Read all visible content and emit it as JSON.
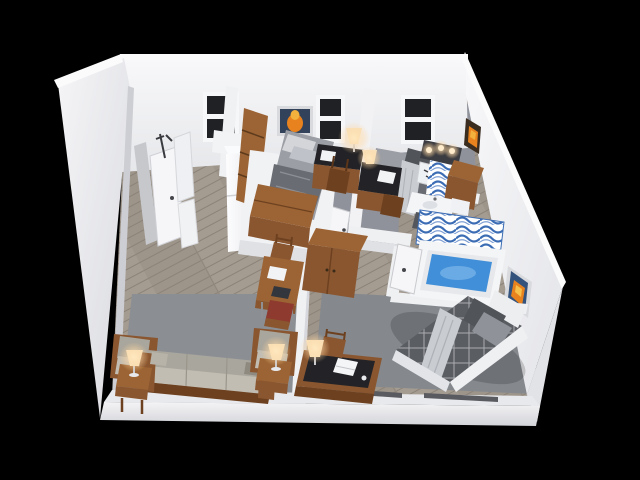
{
  "scene": {
    "description": "3D isometric cutaway floor plan render of a furnished two-bedroom apartment, viewed from above on a black background",
    "background": "#000000"
  },
  "colors": {
    "wall_bright": "#f4f4f6",
    "wall_mid": "#e7e8eb",
    "wall_shadow": "#cfd1d6",
    "wall_top": "#fbfbfc",
    "floor_wood": "#a49b91",
    "carpet_bedroom": "#8f929a",
    "rug_living": "#8b8f94",
    "rug_bedroom3": "#85898e",
    "wood_mid": "#8a5630",
    "wood_dark": "#6d4120",
    "wood_top": "#9c6434",
    "desk_top_black": "#232327",
    "bedding_gray": "#9b9ea4",
    "blanket_dark": "#696c72",
    "comforter_dark": "#5a5d62",
    "pillow_light": "#d3d5d9",
    "pillow_dark": "#515459",
    "drape_light": "#c9ccd1",
    "sofa_back": "#a9a69d",
    "sofa_seat": "#c2bdb2",
    "lamp_shade": "#f7e4c2",
    "water_blue": "#418fd9",
    "curtain_blue": "#3c6db4",
    "window_pane": "#202125",
    "art_orange": "#e8821e",
    "fixture_white": "#f4f5f7",
    "chair_red_seat": "#8e3a2e"
  },
  "rooms": [
    {
      "id": "entry",
      "label": "entry hall",
      "furniture": [
        "entry-door",
        "coat-rack",
        "wall-mirror",
        "shoe-cabinet"
      ]
    },
    {
      "id": "kitchen",
      "label": "kitchenette",
      "furniture": [
        "refrigerator",
        "upper-cabinet"
      ]
    },
    {
      "id": "bedroom-1",
      "label": "bedroom 1",
      "furniture": [
        "twin-bed",
        "storage-chest",
        "tall-bookcase",
        "desk",
        "desk-chair",
        "desk-lamp",
        "wall-art",
        "window"
      ]
    },
    {
      "id": "bedroom-2",
      "label": "bedroom 2",
      "furniture": [
        "twin-bed",
        "desk",
        "desk-chair",
        "desk-lamp",
        "vanity-sink",
        "vanity-lights",
        "striped-towels",
        "window"
      ]
    },
    {
      "id": "bathroom",
      "label": "bathroom",
      "furniture": [
        "bathtub",
        "shower-curtain",
        "toilet",
        "sink-counter",
        "wood-cabinet",
        "bathroom-door",
        "floor-mat"
      ]
    },
    {
      "id": "bedroom-3",
      "label": "bedroom 3",
      "furniture": [
        "double-bed",
        "pillows",
        "throw-blanket",
        "desk",
        "desk-chair",
        "desk-lamp",
        "area-rug",
        "wall-art"
      ]
    },
    {
      "id": "living-room",
      "label": "living room",
      "furniture": [
        "sofa",
        "armchair-left",
        "armchair-right",
        "side-table-left",
        "side-table-right",
        "table-lamp-left",
        "table-lamp-right",
        "area-rug"
      ]
    },
    {
      "id": "dining-area",
      "label": "dining nook",
      "furniture": [
        "dining-table",
        "dining-chair-north",
        "dining-chair-south",
        "armoire"
      ]
    }
  ],
  "counts": {
    "windows": 3,
    "wall_artworks": 3,
    "lit_lamps": 6,
    "vanity_bulbs": 3
  }
}
